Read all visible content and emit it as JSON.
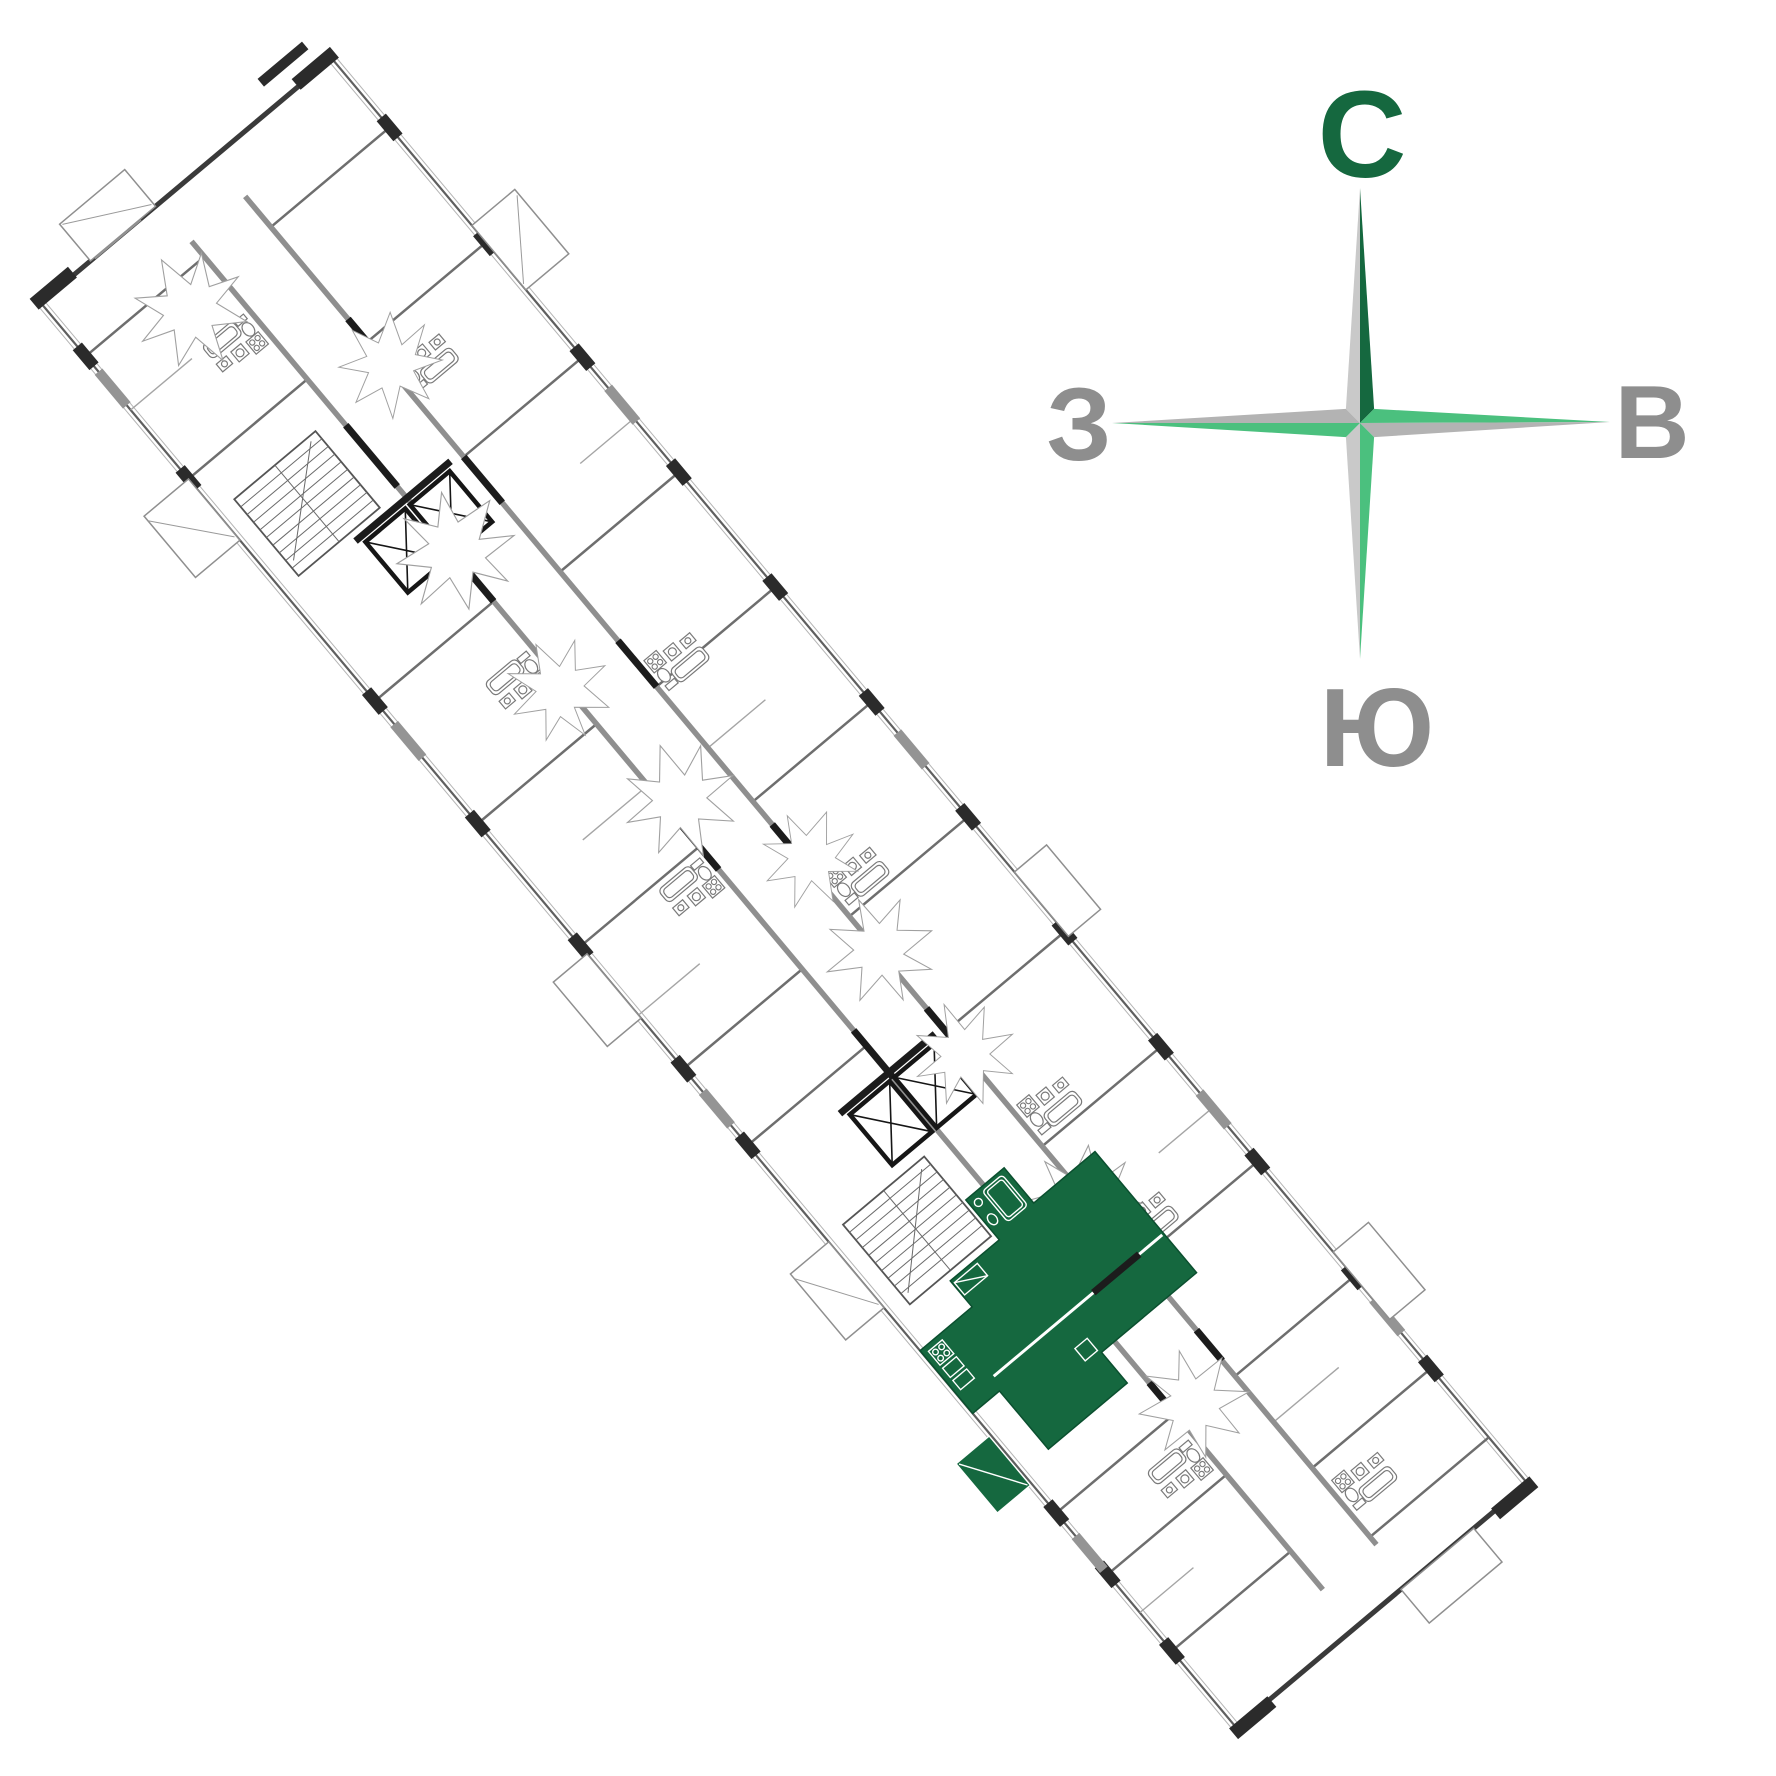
{
  "compass": {
    "north": "С",
    "east": "В",
    "south": "Ю",
    "west": "З"
  },
  "colors": {
    "highlight": "#15683F",
    "compass-dark": "#15683F",
    "compass-green": "#4BC07E",
    "compass-gray-light": "#C9C9C9",
    "compass-gray-mid": "#B3B3B3",
    "label-gray": "#8E8E8E",
    "wall-dark": "#2B2B2B",
    "wall-mid": "#6E6E6E",
    "wall-light": "#9A9A9A"
  },
  "icons": {
    "elevator": "box-with-cross-diagonals",
    "staircase": "tread-lines-with-arrow",
    "entry-hall": "jagged-star-polygon",
    "compass-rose": "four-point-star"
  },
  "floor_plan": {
    "highlighted_apartment": "green-filled unit with balcony, lower third of building"
  }
}
